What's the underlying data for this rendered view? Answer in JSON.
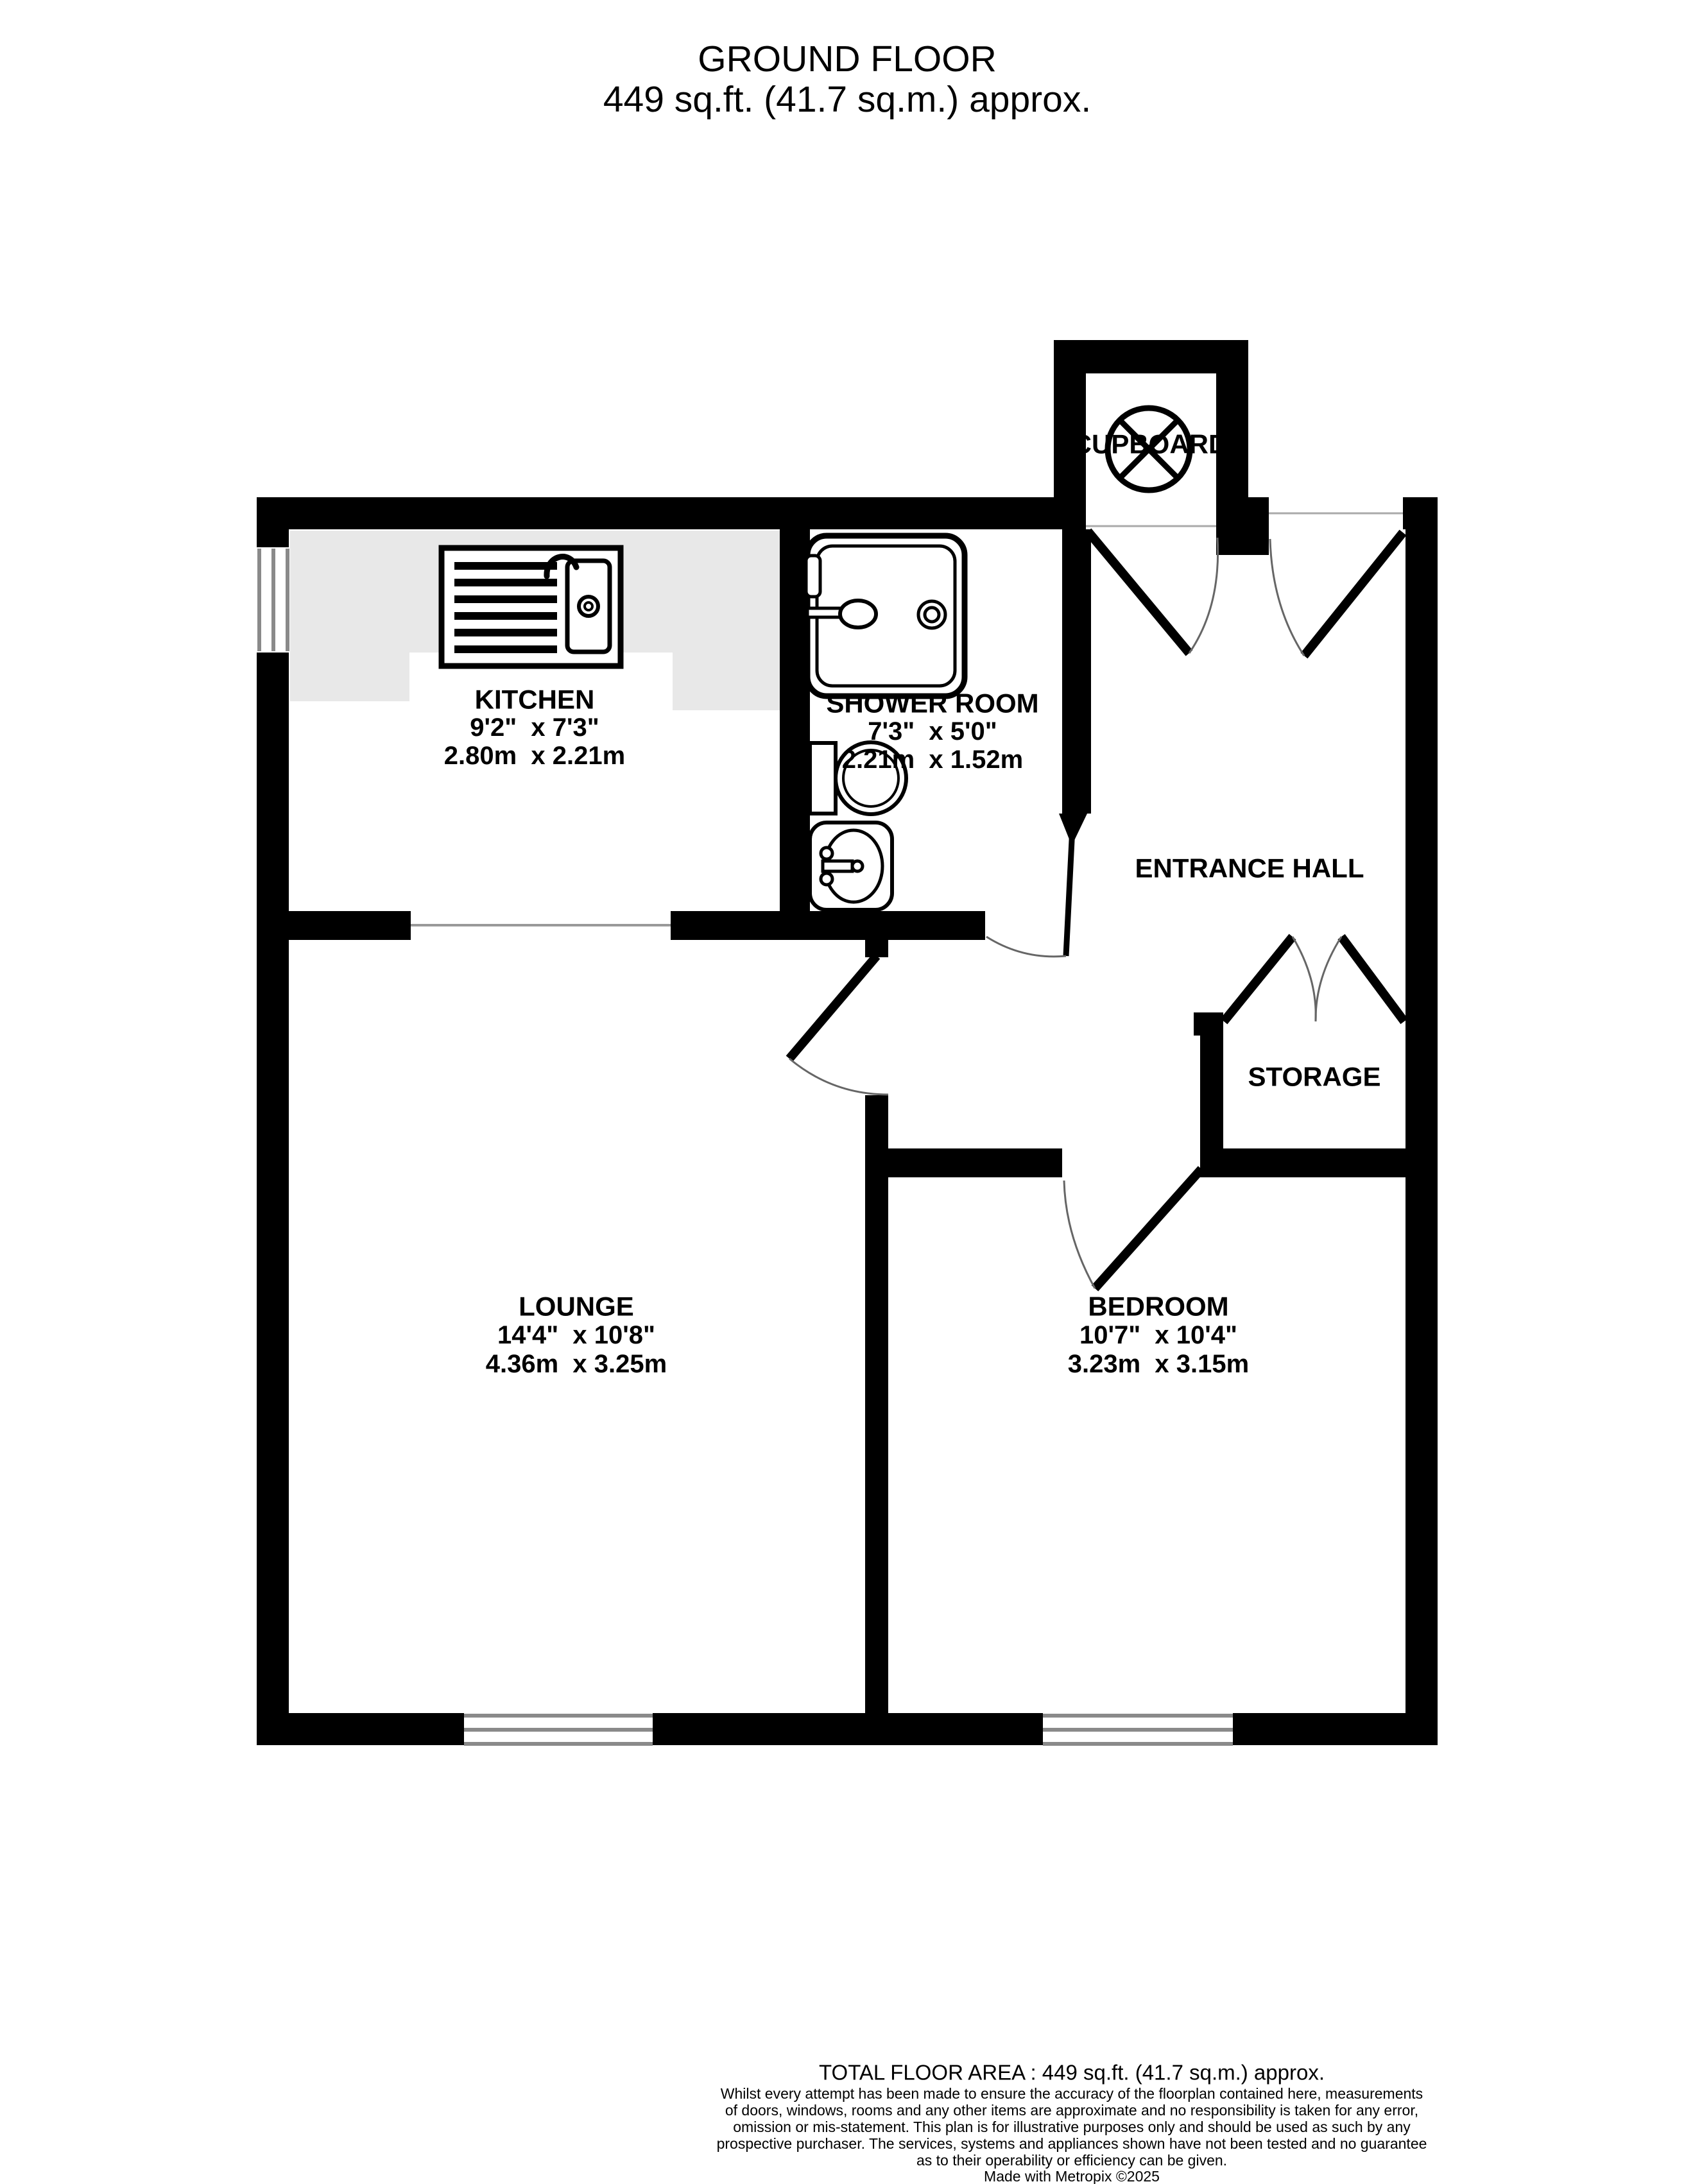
{
  "title": {
    "line1": "GROUND FLOOR",
    "line2": "449 sq.ft. (41.7 sq.m.) approx."
  },
  "rooms": {
    "kitchen": {
      "name": "KITCHEN",
      "imperial": "9'2\"  x 7'3\"",
      "metric": "2.80m  x 2.21m"
    },
    "shower_room": {
      "name": "SHOWER ROOM",
      "imperial": "7'3\"  x 5'0\"",
      "metric": "2.21m  x 1.52m"
    },
    "entrance_hall": {
      "name": "ENTRANCE HALL"
    },
    "cupboard": {
      "name": "CUPBOARD"
    },
    "storage": {
      "name": "STORAGE"
    },
    "lounge": {
      "name": "LOUNGE",
      "imperial": "14'4\"  x 10'8\"",
      "metric": "4.36m  x 3.25m"
    },
    "bedroom": {
      "name": "BEDROOM",
      "imperial": "10'7\"  x 10'4\"",
      "metric": "3.23m  x 3.15m"
    }
  },
  "footer": {
    "total_area": "TOTAL FLOOR AREA : 449 sq.ft. (41.7 sq.m.) approx.",
    "disclaimer_lines": [
      "Whilst every attempt has been made to ensure the accuracy of the floorplan contained here, measurements",
      "of doors, windows, rooms and any other items are approximate and no responsibility is taken for any error,",
      "omission or mis-statement. This plan is for illustrative purposes only and should be used as such by any",
      "prospective purchaser. The services, systems and appliances shown have not been tested and no guarantee",
      "as to their operability or efficiency can be given."
    ],
    "credit": "Made with Metropix ©2025"
  },
  "colors": {
    "wall": "#000000",
    "counter": "#e8e8e8",
    "window_line": "#8a8a8a",
    "background": "#ffffff"
  }
}
